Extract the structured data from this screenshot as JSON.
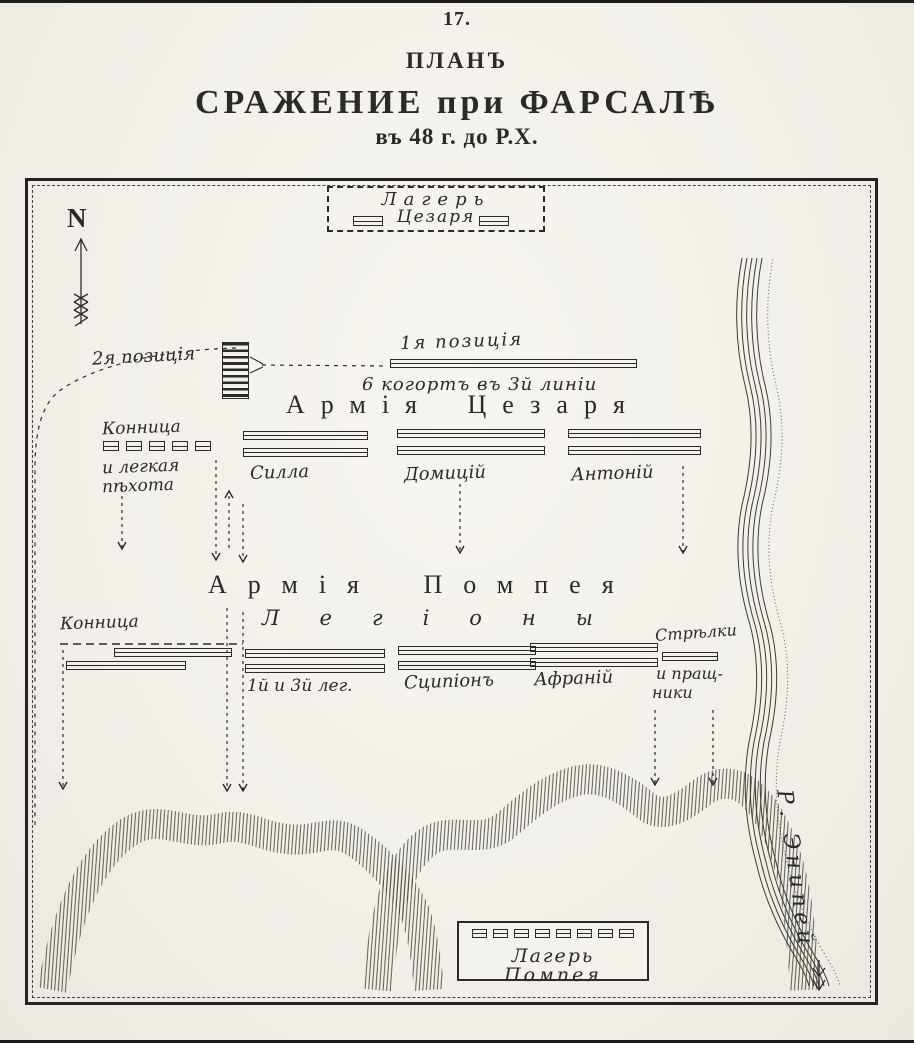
{
  "colors": {
    "ink": "#2b2b28",
    "paper": "#f3f1ea"
  },
  "header": {
    "page_number": "17.",
    "plan": "ПЛАНЪ",
    "battle": "СРАЖЕНИЕ при ФАРСАЛѢ",
    "date": "въ 48 г. до Р.Х."
  },
  "compass": {
    "north": "N"
  },
  "caesar": {
    "camp": {
      "line1": "Лагерь",
      "line2": "Цезаря"
    },
    "position1": "1я позиція",
    "position1_note": "6 когортъ въ 3й линіи",
    "position2": "2я позиція",
    "army_title": "Армія Цезаря",
    "left_flank": {
      "line1": "Конница",
      "line2": "и легкая",
      "line3": "пѣхота"
    },
    "units": [
      "Силла",
      "Домицій",
      "Антоній"
    ]
  },
  "pompey": {
    "army_title": "Армія Помпея",
    "legions": "Легіоны",
    "cavalry": "Конница",
    "units": [
      "1й и 3й лег.",
      "Сципіонъ",
      "Афраній"
    ],
    "right_flank": {
      "line1": "Стрѣлки",
      "line2": "и пращ-",
      "line3": "ники"
    },
    "camp": {
      "line1": "Лагерь",
      "line2": "Помпея"
    }
  },
  "river": {
    "label": "Р. Энипей"
  }
}
